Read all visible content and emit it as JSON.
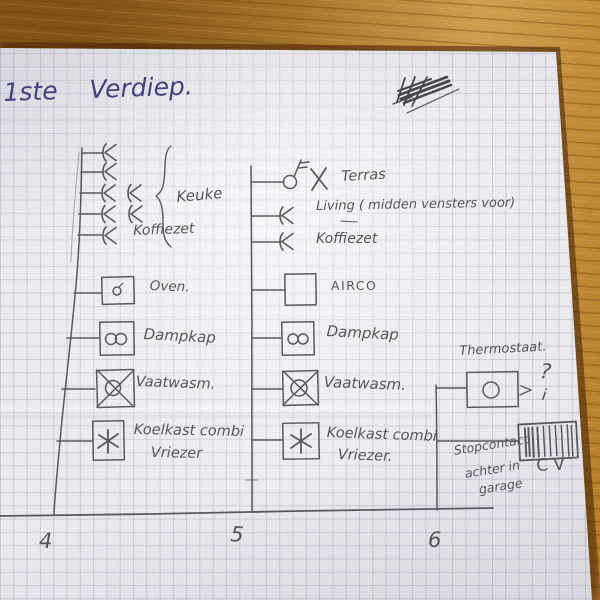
{
  "page_title": "1ste Verdiep.",
  "colors": {
    "ink": "#45417b",
    "pencil": "#55565b",
    "wood": "#b07426",
    "paper": "#eae9ee"
  },
  "circuits": [
    {
      "number": "4",
      "group_label": "Keuke",
      "labels": {
        "koffiezet": "Koffiezet",
        "oven": "Oven.",
        "dampkap": "Dampkap",
        "vaatwasmachine": "Vaatwasm.",
        "koelkast_line1": "Koelkast combi",
        "koelkast_line2": "Vriezer"
      }
    },
    {
      "number": "5",
      "labels": {
        "terras": "Terras",
        "living": "Living ( midden vensters voor)",
        "koffiezet": "Koffiezet",
        "airco": "AIRCO",
        "dampkap": "Dampkap",
        "vaatwasmachine": "Vaatwasm.",
        "koelkast_line1": "Koelkast combi",
        "koelkast_line2": "Vriezer."
      }
    },
    {
      "number": "6",
      "labels": {
        "thermostaat": "Thermostaat.",
        "question_mark": "?",
        "mark": "i",
        "cv": "CV",
        "note_line1": "Stopcontact",
        "note_line2": "achter in",
        "note_line3": "garage"
      }
    }
  ]
}
